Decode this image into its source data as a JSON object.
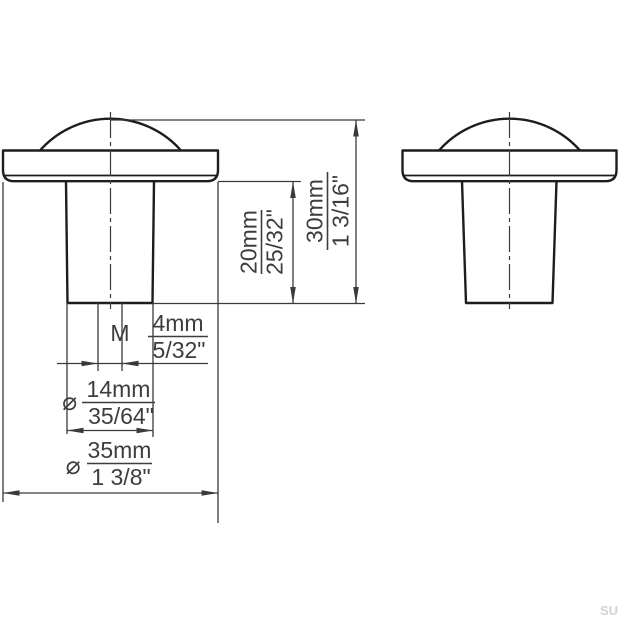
{
  "style": {
    "background": "#ffffff",
    "line_color": "#1d1d1d",
    "thin_line_color": "#3a3a3a",
    "text_color": "#3d3d3d",
    "watermark_color": "#d2d2d2"
  },
  "watermark": "SU",
  "dimensions": {
    "stem_height": {
      "metric": "20mm",
      "imperial": "25/32\""
    },
    "total_height": {
      "metric": "30mm",
      "imperial": "1 3/16\""
    },
    "thread": {
      "prefix": "M",
      "metric": "4mm",
      "imperial": "5/32\""
    },
    "neck_diameter": {
      "symbol": "⌀",
      "metric": "14mm",
      "imperial": "35/64\""
    },
    "cap_diameter": {
      "symbol": "⌀",
      "metric": "35mm",
      "imperial": "1 3/8\""
    }
  }
}
